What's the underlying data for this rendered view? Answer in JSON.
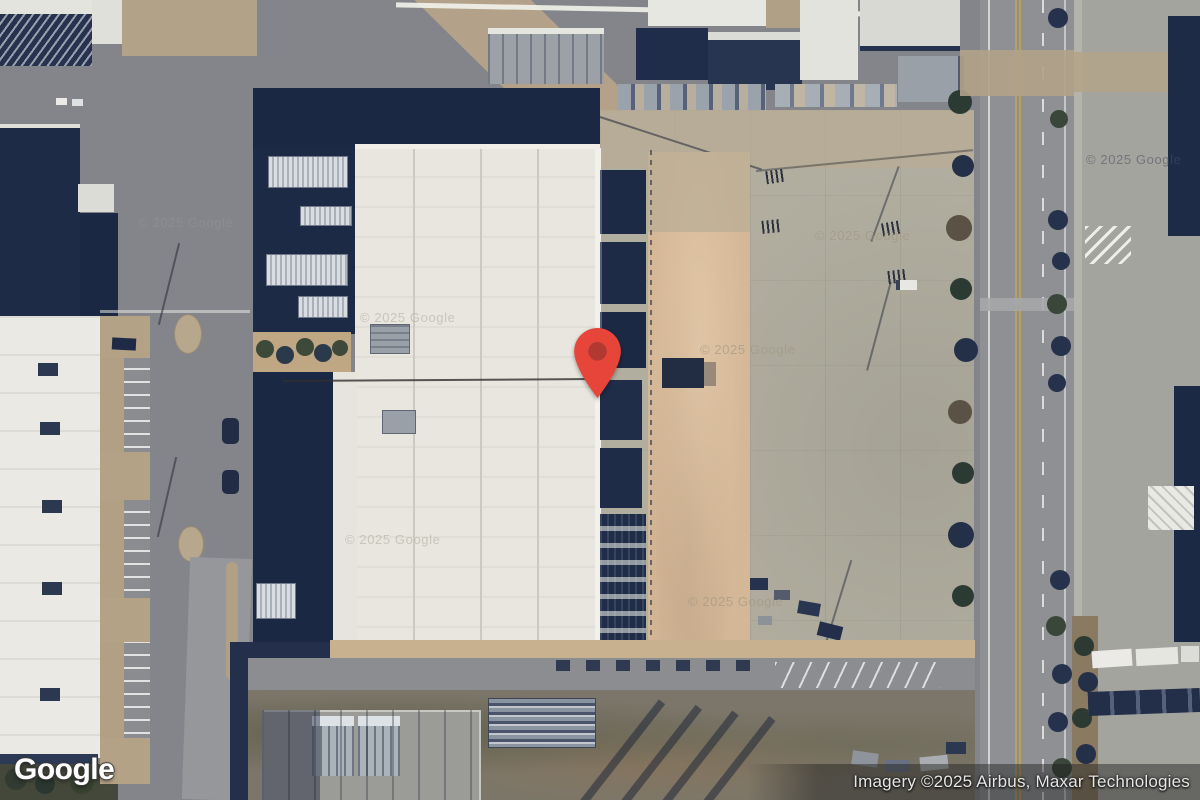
{
  "map": {
    "logo_text": "Google",
    "attribution_text": "Imagery ©2025 Airbus, Maxar Technologies",
    "watermark_text": "© 2025 Google",
    "marker": {
      "label": "location-pin",
      "fill": "#E8453A",
      "dot": "#B23931"
    }
  },
  "palette": {
    "asphalt": "#83858A",
    "roof_white": "#E8E6DE",
    "navy_building": "#1B2843",
    "dirt_yard": "#D3B797",
    "concrete_yard": "#B1AEA0",
    "road": "#8E9094",
    "tan_road": "#B3A289",
    "vegetation": "#2C3832"
  }
}
